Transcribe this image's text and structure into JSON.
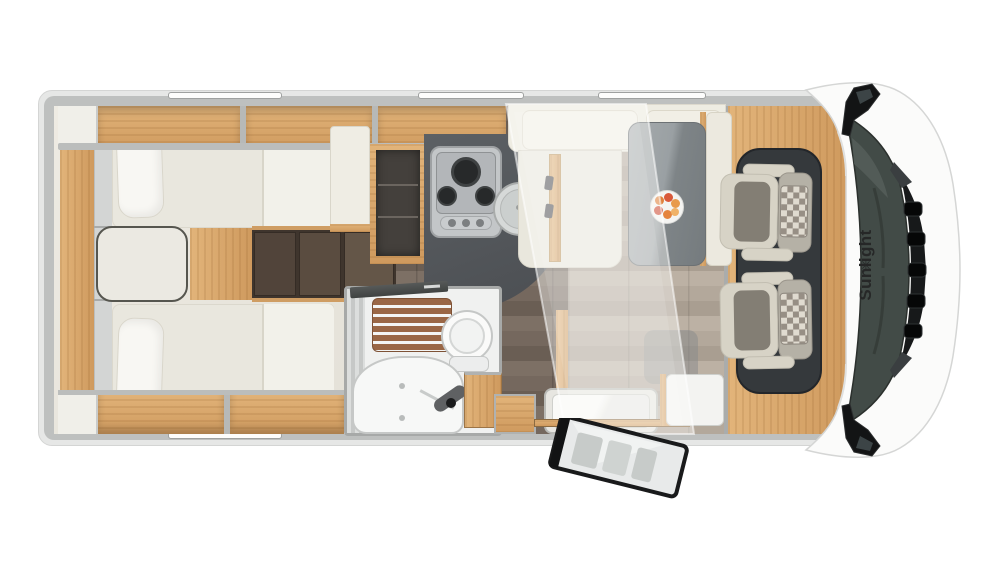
{
  "brand": {
    "name": "Sunlight",
    "logo_symbol": "✳"
  },
  "vehicle_front": {
    "mirror_count": 2,
    "wiper_count": 2
  },
  "cab": {
    "swivel_seat_count": 2,
    "checkered_pillow_count": 2
  },
  "kitchen": {
    "burner_count": 3,
    "knob_count": 3,
    "sink_count": 1
  },
  "bathroom": {
    "fixtures": [
      "shower-grate",
      "toilet",
      "washbasin",
      "vanity-cabinet"
    ]
  },
  "bedroom": {
    "bed_count": 2,
    "pillow_count": 2,
    "wardrobe_door_count": 3
  },
  "dinette": {
    "bench_headrest_count": 2,
    "seatbelt_count": 2,
    "plate_count": 1
  },
  "windows": {
    "top_count": 3,
    "bottom_count": 1
  },
  "colors": {
    "body_white": "#fbfbfa",
    "wall_gray": "#bec0bf",
    "oak_wood": "#cf9a5e",
    "oak_light": "#e2b47a",
    "dark_wood_floor": "#6e6156",
    "living_floor": "#ab9f93",
    "counter_dark": "#53565a",
    "mattress_cream": "#e9e7de",
    "wardrobe_dark": "#51443a",
    "cab_floor": "#35393c",
    "seat_cream": "#d7d3c6",
    "glass_dark": "#424b47",
    "logo_text": "#262727",
    "fruit_orange": "#e0813c",
    "fruit_red": "#d9593a"
  }
}
